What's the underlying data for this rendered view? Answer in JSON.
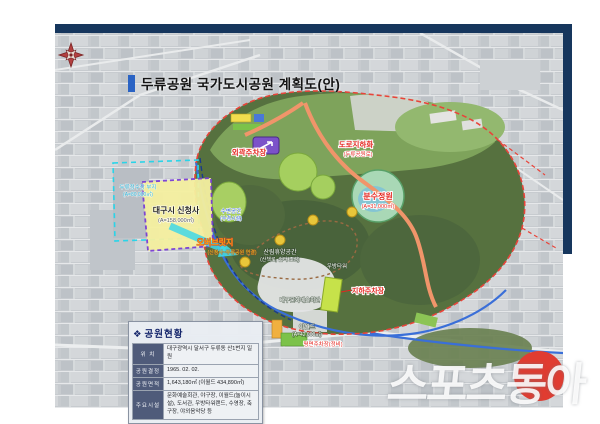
{
  "page": {
    "title": "두류공원 국가도시공원 계획도(안)"
  },
  "watermark": {
    "text": "스포츠동아"
  },
  "legend_box": {
    "icon": "❖",
    "title": "공원현황",
    "rows": [
      {
        "label": "위  치",
        "value": "대구광역시 달서구 두류동 산1번지 일원"
      },
      {
        "label": "공원결정",
        "value": "1965. 02. 02."
      },
      {
        "label": "공원면적",
        "value": "1,643,180㎡ (이월드 434,890㎡)"
      },
      {
        "label": "주요시설",
        "value": "문화예술회관, 야구장, 이월드(놀이시설), 도서관, 우방타워랜드, 수영장, 축구장, 야외음악당 등"
      }
    ]
  },
  "map": {
    "labels": {
      "new_cityhall": "대구시 신청사",
      "new_cityhall_sub": "(A=158,000㎡)",
      "waterworks_site": "두류정수장 부지",
      "waterworks_site_sub": "(A=80,000㎡)",
      "overbridge": "오버브릿지",
      "overbridge_sub": "(신청사~두류공원 연결)",
      "outer_parking": "외곽주차장",
      "road_underground": "도로지하화",
      "road_underground_sub": "(두류공원로)",
      "fountain_garden": "분수정원",
      "fountain_garden_sub": "(A=31,000㎡)",
      "waterside": "수변공간",
      "waterside_sub": "(수경시설)",
      "forest_rest": "산림휴양공간",
      "forest_rest_sub": "(산책로, 쉼터 조성)",
      "arts_center": "대구문화예술회관",
      "woobang_tower": "우방타워",
      "underground_parking": "지하주차장",
      "eworld": "이월드",
      "eworld_sub": "(A=42,000㎡)",
      "flat_parking": "평면주차장(정비)"
    },
    "colors": {
      "frame_navy": "#16365d",
      "title_accent_blue": "#2a63c4",
      "park_boundary_red": "#e8443a",
      "cityhall_yellow": "#f5f0a0",
      "cityhall_border_purple": "#7a3fd4",
      "overbridge_cyan": "#42d8e8",
      "road_orange": "#f0956a",
      "water_blue": "#3a6fd8",
      "watermark_red": "#e03c31"
    }
  }
}
